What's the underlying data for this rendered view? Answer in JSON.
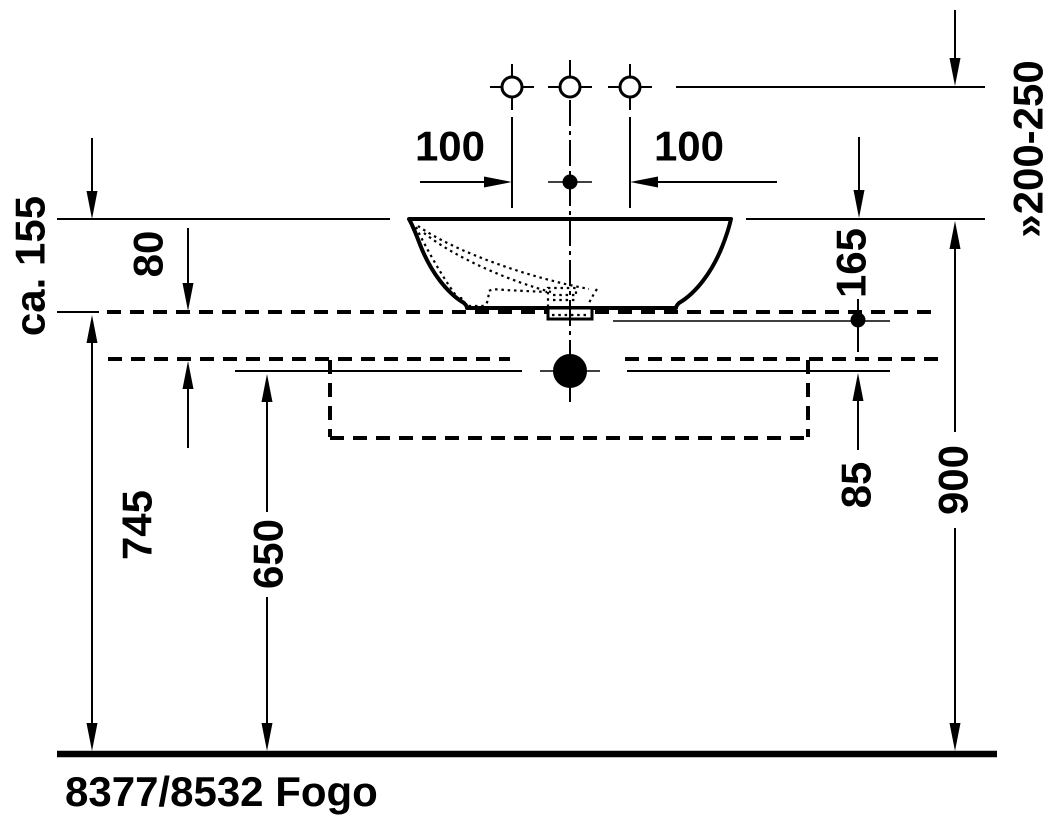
{
  "product_label": "8377/8532 Fogo",
  "labels": {
    "ca_155": "ca. 155",
    "d80": "80",
    "d100_left": "100",
    "d100_right": "100",
    "d165": "165",
    "d200_250": "»200-250",
    "d85": "85",
    "d650": "650",
    "d745": "745",
    "d900": "900"
  },
  "colors": {
    "ink": "#000000",
    "background": "#ffffff"
  }
}
